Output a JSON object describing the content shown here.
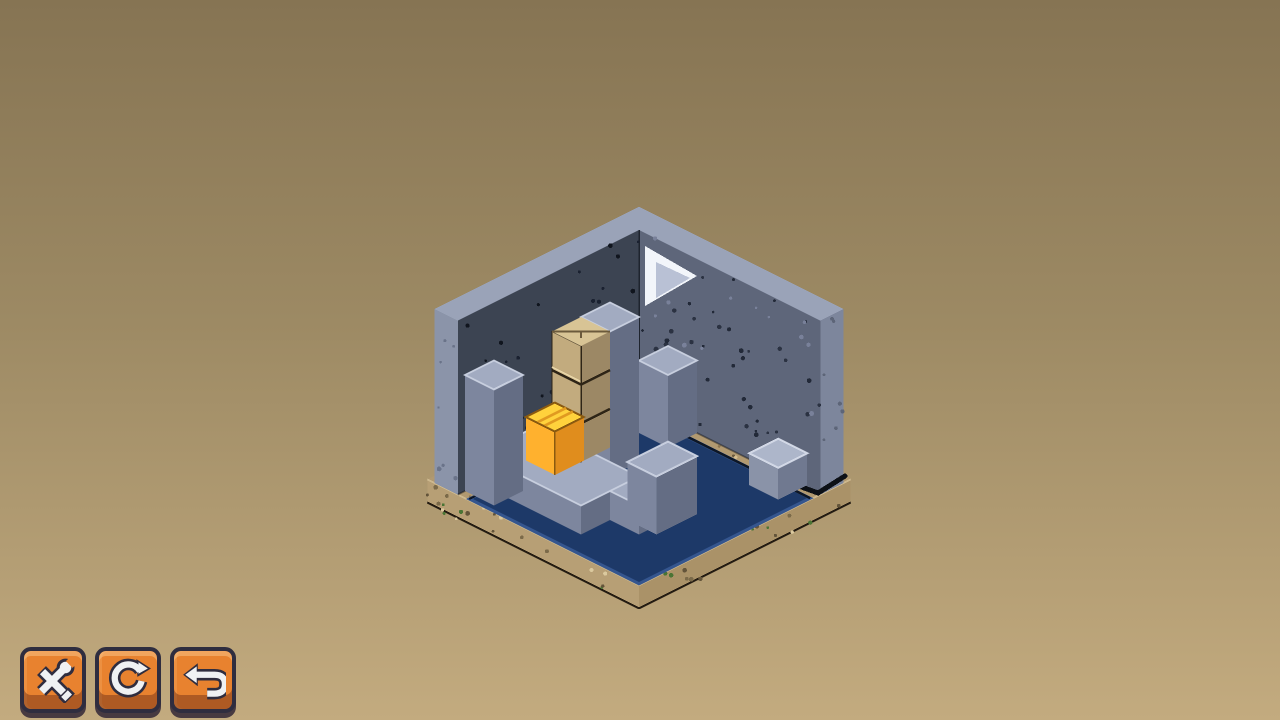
{
  "app": {
    "title": "Isometric block puzzle level"
  },
  "background": {
    "gradient_top": "#867453",
    "gradient_mid": "#9d8a64",
    "gradient_bottom": "#c3ab7f"
  },
  "toolbar": {
    "button_color": "#e8822f",
    "buttons": [
      {
        "name": "settings",
        "icon": "tools-icon"
      },
      {
        "name": "restart level",
        "icon": "restart-icon"
      },
      {
        "name": "undo move",
        "icon": "undo-icon"
      }
    ]
  },
  "scene": {
    "origin": {
      "x": 639,
      "y": 404
    },
    "tile": {
      "half_w": 29,
      "half_h": 14.5,
      "unit_h": 29
    },
    "room": {
      "size": 6.25,
      "wall_height": 6,
      "wall_thickness": 0.8,
      "dirt_overhang": 1.05,
      "dirt_depth": 0.8
    },
    "palettes": {
      "gray": {
        "top": "#a2abc1",
        "left": "#7d869e",
        "right": "#646d84",
        "edge": "#c7cede"
      },
      "gray_light": {
        "top": "#adb6ca",
        "left": "#8a93a8",
        "right": "#707990",
        "edge": "#d2d8e6"
      },
      "cardboard": {
        "top": "#d8c495",
        "left": "#c2ab7e",
        "right": "#9c8865",
        "seam": "#2e2517",
        "crease": "#e8d6a8",
        "topseam": "#6b5a3c"
      },
      "yellow": {
        "top": "#ffd23c",
        "left": "#ffb12e",
        "right": "#e08d1d",
        "seam": "#e09a20",
        "edge": "#8a5a10"
      },
      "dirt": {
        "top": "#b19970",
        "left": "#b79f75",
        "right": "#aa9268",
        "edge_hi": "#cdb88e",
        "edge_dark": "#241c12",
        "speckles": [
          "#63543a",
          "#7b6a49",
          "#4a7434",
          "#dbc99e"
        ]
      },
      "wall": {
        "left_inner": "#3c4452",
        "right_inner": "#5e667a",
        "rim": "#9aa3b8",
        "cap_left": "#8b94a9",
        "cap_right": "#7d869c",
        "speckle_left": [
          "#10151e",
          "#1a2130"
        ],
        "speckle_right": [
          "#2b3242",
          "#222938",
          "#79819a"
        ],
        "corner_line": "#1e242e"
      },
      "water": {
        "fill": "#1d3968",
        "edge": "#35568f",
        "dark_edge": "#0e1726"
      }
    },
    "window_arrow": {
      "color": "#f2f5fa",
      "shade": "#b9c1d5",
      "main": [
        [
          645,
          246
        ],
        [
          645,
          306
        ],
        [
          697,
          276
        ]
      ],
      "inner": [
        [
          656,
          262
        ],
        [
          656,
          298
        ],
        [
          690,
          278
        ]
      ]
    },
    "water_poly": [
      [
        0.35,
        0.3
      ],
      [
        6.2,
        0.3
      ],
      [
        6.2,
        6.2
      ],
      [
        0.35,
        6.2
      ]
    ],
    "objects": [
      {
        "name": "bench-block",
        "i": 1.0,
        "j": 0.0,
        "k": 0,
        "w": 1.0,
        "d": 1.0,
        "h": 2.5,
        "palette": "gray"
      },
      {
        "name": "mid-pillar",
        "i": 1.0,
        "j": 2.0,
        "k": 0,
        "w": 1.0,
        "d": 1.0,
        "h": 5.0,
        "palette": "gray"
      },
      {
        "name": "main-platform",
        "i": 0.0,
        "j": 3.5,
        "k": 0,
        "w": 3.5,
        "d": 2.0,
        "h": 1.0,
        "palette": "gray"
      },
      {
        "name": "platform-arm",
        "i": 3.5,
        "j": 3.0,
        "k": 0,
        "w": 1.0,
        "d": 1.5,
        "h": 1.0,
        "palette": "gray"
      },
      {
        "name": "arm-knob",
        "i": 3.8,
        "j": 2.8,
        "k": 0,
        "w": 1.0,
        "d": 1.4,
        "h": 2.0,
        "palette": "gray"
      },
      {
        "name": "crate-stack",
        "i": 1.0,
        "j": 3.0,
        "k": 1,
        "w": 1.0,
        "d": 1.0,
        "h": 4.0,
        "palette": "cardboard",
        "detail": "crate",
        "seams": [
          0.333,
          0.667
        ]
      },
      {
        "name": "yellow-crate",
        "i": 0.0,
        "j": 2.9,
        "k": 0,
        "w": 1.0,
        "d": 1.0,
        "h": 1.5,
        "palette": "yellow",
        "detail": "flaps",
        "seams": [
          0.38,
          0.62
        ]
      },
      {
        "name": "left-pillar",
        "i": 0.0,
        "j": 5.0,
        "k": 0,
        "w": 1.0,
        "d": 1.0,
        "h": 4.0,
        "palette": "gray"
      },
      {
        "name": "small-block",
        "i": 4.7,
        "j": -0.1,
        "k": 0,
        "w": 1.0,
        "d": 1.0,
        "h": 1.1,
        "palette": "gray_light"
      }
    ]
  }
}
